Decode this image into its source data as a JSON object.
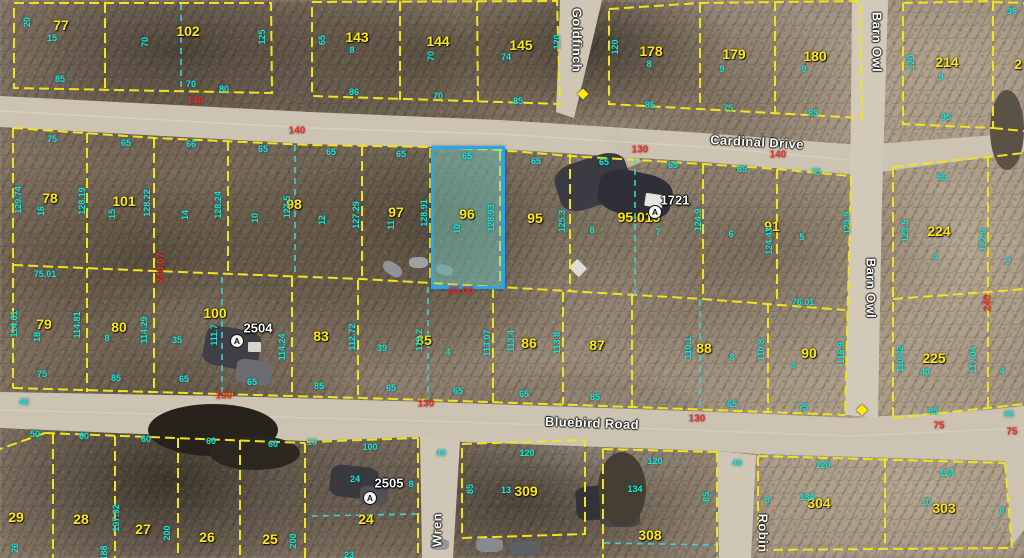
{
  "colors": {
    "parcel_line": "#f2e41c",
    "lot_split_dash": "#43cfd2",
    "highlight_stroke": "#2ba4e9",
    "highlight_fill": "rgba(118,212,201,0.45)",
    "lot_number": "#ffe912",
    "dimension_cyan": "#1de6da",
    "dimension_red": "#e03128",
    "road_fill": "#ccc3b2"
  },
  "highlight": {
    "parcel": "96",
    "x": 431,
    "y": 146,
    "w": 68,
    "h": 137
  },
  "roads": {
    "names": [
      [
        "Cardinal Drive",
        757,
        142,
        3
      ],
      [
        "Bluebird Road",
        592,
        423,
        2
      ],
      [
        "Barn Owl",
        877,
        42,
        90
      ],
      [
        "Barn Owl",
        871,
        288,
        90
      ],
      [
        "Goldfinch",
        577,
        40,
        90
      ],
      [
        "Wren",
        437,
        530,
        -90
      ],
      [
        "Robin",
        763,
        533,
        90
      ]
    ]
  },
  "labels": {
    "parcels": [
      [
        "77",
        61,
        25
      ],
      [
        "102",
        188,
        31
      ],
      [
        "143",
        357,
        37
      ],
      [
        "144",
        438,
        41
      ],
      [
        "145",
        521,
        45
      ],
      [
        "178",
        651,
        51
      ],
      [
        "179",
        734,
        54
      ],
      [
        "180",
        815,
        56
      ],
      [
        "214",
        947,
        62
      ],
      [
        "2",
        1018,
        64
      ],
      [
        "78",
        50,
        198
      ],
      [
        "101",
        124,
        201
      ],
      [
        "98",
        294,
        204
      ],
      [
        "97",
        396,
        212
      ],
      [
        "96",
        467,
        214
      ],
      [
        "95",
        535,
        218
      ],
      [
        "95.019",
        639,
        217
      ],
      [
        "91",
        772,
        226
      ],
      [
        "224",
        939,
        231
      ],
      [
        "79",
        44,
        324
      ],
      [
        "80",
        119,
        327
      ],
      [
        "100",
        215,
        313
      ],
      [
        "83",
        321,
        336
      ],
      [
        "85",
        424,
        340
      ],
      [
        "86",
        529,
        343
      ],
      [
        "87",
        597,
        345
      ],
      [
        "88",
        704,
        348
      ],
      [
        "90",
        809,
        353
      ],
      [
        "225",
        934,
        358
      ],
      [
        "29",
        16,
        517
      ],
      [
        "28",
        81,
        519
      ],
      [
        "27",
        143,
        529
      ],
      [
        "26",
        207,
        537
      ],
      [
        "25",
        270,
        539
      ],
      [
        "24",
        366,
        519
      ],
      [
        "309",
        526,
        491
      ],
      [
        "308",
        650,
        535
      ],
      [
        "304",
        819,
        503
      ],
      [
        "303",
        944,
        508
      ]
    ],
    "addresses": [
      [
        "1721",
        675,
        200
      ],
      [
        "2504",
        258,
        328
      ],
      [
        "2505",
        389,
        483
      ]
    ],
    "dims_cyan": [
      [
        "20",
        27,
        22,
        "v"
      ],
      [
        "15",
        52,
        38,
        "h"
      ],
      [
        "85",
        60,
        79,
        "h"
      ],
      [
        "70",
        145,
        42,
        "v"
      ],
      [
        "70",
        191,
        84,
        "h"
      ],
      [
        "80",
        224,
        89,
        "h"
      ],
      [
        "125",
        262,
        37,
        "v"
      ],
      [
        "65",
        322,
        40,
        "v"
      ],
      [
        "8",
        352,
        50,
        "h"
      ],
      [
        "86",
        354,
        92,
        "h"
      ],
      [
        "70",
        431,
        56,
        "v"
      ],
      [
        "70",
        438,
        96,
        "h"
      ],
      [
        "74",
        506,
        57,
        "h"
      ],
      [
        "85",
        518,
        101,
        "h"
      ],
      [
        "120",
        557,
        42,
        "v"
      ],
      [
        "120",
        615,
        47,
        "v"
      ],
      [
        "8",
        649,
        64,
        "h"
      ],
      [
        "85",
        650,
        105,
        "h"
      ],
      [
        "9",
        722,
        69,
        "h"
      ],
      [
        "75",
        728,
        108,
        "h"
      ],
      [
        "9",
        804,
        69,
        "h"
      ],
      [
        "85",
        813,
        113,
        "h"
      ],
      [
        "120",
        911,
        62,
        "v"
      ],
      [
        "9",
        941,
        77,
        "h"
      ],
      [
        "95",
        946,
        117,
        "h"
      ],
      [
        "36",
        1012,
        11,
        "h"
      ],
      [
        "75",
        52,
        139,
        "h"
      ],
      [
        "65",
        126,
        143,
        "h"
      ],
      [
        "66",
        191,
        144,
        "h"
      ],
      [
        "65",
        263,
        149,
        "h"
      ],
      [
        "65",
        331,
        152,
        "h"
      ],
      [
        "65",
        401,
        154,
        "h"
      ],
      [
        "65",
        467,
        156,
        "h"
      ],
      [
        "65",
        536,
        161,
        "h"
      ],
      [
        "65",
        604,
        162,
        "h"
      ],
      [
        "65",
        673,
        165,
        "h"
      ],
      [
        "65",
        742,
        169,
        "h"
      ],
      [
        "75",
        816,
        172,
        "h"
      ],
      [
        "95",
        942,
        177,
        "h"
      ],
      [
        "129.74",
        18,
        200,
        "v"
      ],
      [
        "16",
        41,
        211,
        "v"
      ],
      [
        "128.19",
        82,
        201,
        "v"
      ],
      [
        "15",
        112,
        214,
        "v"
      ],
      [
        "128.22",
        147,
        203,
        "v"
      ],
      [
        "14",
        185,
        215,
        "v"
      ],
      [
        "128.24",
        218,
        205,
        "v"
      ],
      [
        "10",
        255,
        218,
        "v"
      ],
      [
        "127.5",
        287,
        207,
        "v"
      ],
      [
        "12",
        322,
        220,
        "v"
      ],
      [
        "127.29",
        356,
        215,
        "v"
      ],
      [
        "11",
        391,
        225,
        "v"
      ],
      [
        "128.91",
        424,
        213,
        "v"
      ],
      [
        "10",
        457,
        229,
        "v"
      ],
      [
        "128.93",
        491,
        218,
        "v"
      ],
      [
        "125.3",
        562,
        221,
        "v"
      ],
      [
        "8",
        592,
        230,
        "h"
      ],
      [
        "7",
        658,
        232,
        "h"
      ],
      [
        "124.9",
        698,
        220,
        "v"
      ],
      [
        "6",
        731,
        234,
        "h"
      ],
      [
        "124.43",
        769,
        241,
        "v"
      ],
      [
        "5",
        802,
        237,
        "h"
      ],
      [
        "123.9",
        847,
        223,
        "v"
      ],
      [
        "123.5",
        905,
        231,
        "v"
      ],
      [
        "122.9",
        983,
        240,
        "v"
      ],
      [
        "4",
        935,
        257,
        "h"
      ],
      [
        "9",
        1008,
        261,
        "h"
      ],
      [
        "75.01",
        45,
        274,
        "h"
      ],
      [
        "76.01",
        803,
        302,
        "h"
      ],
      [
        "114.61",
        14,
        324,
        "v"
      ],
      [
        "18",
        37,
        337,
        "v"
      ],
      [
        "114.81",
        77,
        325,
        "v"
      ],
      [
        "8",
        107,
        338,
        "h"
      ],
      [
        "114.29",
        144,
        330,
        "v"
      ],
      [
        "35",
        177,
        340,
        "h"
      ],
      [
        "111.7",
        214,
        335,
        "v"
      ],
      [
        "114.24",
        282,
        347,
        "v"
      ],
      [
        "112.72",
        352,
        337,
        "v"
      ],
      [
        "39",
        382,
        348,
        "h"
      ],
      [
        "113.2",
        419,
        340,
        "v"
      ],
      [
        "4",
        448,
        352,
        "h"
      ],
      [
        "113.07",
        487,
        343,
        "v"
      ],
      [
        "113.4",
        511,
        341,
        "v"
      ],
      [
        "113.8",
        557,
        343,
        "v"
      ],
      [
        "110.1",
        688,
        348,
        "v"
      ],
      [
        "8",
        732,
        357,
        "h"
      ],
      [
        "110.8",
        761,
        350,
        "v"
      ],
      [
        "4",
        793,
        366,
        "h"
      ],
      [
        "116.9",
        841,
        353,
        "v"
      ],
      [
        "110.42",
        900,
        359,
        "v"
      ],
      [
        "40",
        925,
        372,
        "h"
      ],
      [
        "117.04",
        973,
        360,
        "v"
      ],
      [
        "4",
        1002,
        371,
        "h"
      ],
      [
        "75",
        42,
        374,
        "h"
      ],
      [
        "85",
        116,
        378,
        "h"
      ],
      [
        "65",
        184,
        379,
        "h"
      ],
      [
        "65",
        252,
        382,
        "h"
      ],
      [
        "85",
        319,
        386,
        "h"
      ],
      [
        "65",
        391,
        388,
        "h"
      ],
      [
        "65",
        458,
        391,
        "h"
      ],
      [
        "65",
        524,
        394,
        "h"
      ],
      [
        "85",
        595,
        397,
        "h"
      ],
      [
        "65",
        732,
        404,
        "h"
      ],
      [
        "75",
        803,
        407,
        "h"
      ],
      [
        "85",
        933,
        411,
        "h"
      ],
      [
        "65",
        1009,
        414,
        "h"
      ],
      [
        "40",
        24,
        402,
        "h"
      ],
      [
        "50",
        35,
        434,
        "h"
      ],
      [
        "60",
        84,
        436,
        "h"
      ],
      [
        "60",
        146,
        439,
        "h"
      ],
      [
        "60",
        211,
        441,
        "h"
      ],
      [
        "60",
        273,
        444,
        "h"
      ],
      [
        "10",
        312,
        442,
        "h"
      ],
      [
        "100",
        370,
        447,
        "h"
      ],
      [
        "24",
        355,
        479,
        "h"
      ],
      [
        "8",
        411,
        484,
        "h"
      ],
      [
        "40",
        441,
        453,
        "h"
      ],
      [
        "120",
        527,
        453,
        "h"
      ],
      [
        "85",
        470,
        489,
        "v"
      ],
      [
        "13",
        506,
        490,
        "h"
      ],
      [
        "120",
        655,
        461,
        "h"
      ],
      [
        "134",
        635,
        489,
        "h"
      ],
      [
        "85",
        706,
        497,
        "v"
      ],
      [
        "40",
        737,
        463,
        "h"
      ],
      [
        "120",
        823,
        465,
        "h"
      ],
      [
        "8",
        767,
        500,
        "h"
      ],
      [
        "134",
        807,
        497,
        "h"
      ],
      [
        "124",
        947,
        473,
        "h"
      ],
      [
        "10",
        926,
        502,
        "h"
      ],
      [
        "8",
        1002,
        511,
        "h"
      ],
      [
        "197.92",
        116,
        518,
        "v"
      ],
      [
        "200",
        167,
        533,
        "v"
      ],
      [
        "200",
        293,
        541,
        "v"
      ],
      [
        "26",
        15,
        548,
        "v"
      ],
      [
        "23",
        349,
        555,
        "h"
      ],
      [
        "188",
        104,
        553,
        "v"
      ]
    ],
    "dims_red": [
      [
        "140",
        195,
        101,
        "h"
      ],
      [
        "140",
        297,
        131,
        "h"
      ],
      [
        "130",
        640,
        150,
        "h"
      ],
      [
        "140",
        778,
        155,
        "h"
      ],
      [
        "240.07",
        161,
        268,
        "v"
      ],
      [
        "130",
        224,
        396,
        "h"
      ],
      [
        "130",
        426,
        404,
        "h"
      ],
      [
        "130",
        697,
        419,
        "h"
      ],
      [
        "75",
        939,
        426,
        "h"
      ],
      [
        "75",
        1012,
        432,
        "h"
      ],
      [
        "240",
        988,
        303,
        "v"
      ],
      [
        "65.00",
        461,
        291,
        "h"
      ]
    ],
    "markers_a": [
      [
        237,
        341
      ],
      [
        655,
        212
      ],
      [
        370,
        498
      ]
    ],
    "survey_dots": [
      [
        583,
        94
      ],
      [
        862,
        410
      ]
    ]
  },
  "geometry": {
    "yellow_lines": [
      "14,3 271,3 272,93 14,88 14,3",
      "105,3 105,90",
      "312,2 557,1 560,104 312,96 312,2",
      "400,1 400,100",
      "477,1 478,102",
      "609,9 700,3 860,1 862,118 609,104 609,9",
      "700,3 700,109",
      "775,1 775,113",
      "903,3 993,1 993,128 903,124 903,3",
      "993,2 1024,3",
      "993,128 1024,131",
      "13,128 155,138 310,145 430,147 500,150 570,156 703,164 777,169 851,176",
      "851,176 845,415",
      "13,128 13,388",
      "13,388 222,394 430,400 632,407 768,412 845,415",
      "13,265 155,271 362,279 500,287 703,299 845,310",
      "87,133 87,392",
      "154,138 154,393",
      "228,141 228,275",
      "362,146 362,279",
      "430,148 430,283",
      "500,151 500,287",
      "570,154 570,291",
      "703,164 703,299",
      "777,169 777,304",
      "292,277 292,396",
      "358,280 358,398",
      "493,288 493,402",
      "563,292 563,404",
      "632,295 632,407",
      "768,303 768,412",
      "893,167 988,157 1024,153",
      "893,167 893,418",
      "893,299 988,292 1024,289",
      "893,418 988,408 1024,404",
      "988,157 988,408",
      "45,433 305,443",
      "45,433 0,449",
      "53,434 53,558",
      "115,436 115,558",
      "178,438 178,558",
      "240,440 240,558",
      "305,443 305,558",
      "307,442 418,438",
      "418,438 418,558",
      "462,444 585,440 585,534 462,538 462,444",
      "603,449 717,452",
      "603,449 603,558",
      "717,452 717,558",
      "758,456 1005,463",
      "758,456 758,550",
      "885,458 885,549",
      "758,550 1012,548",
      "1005,463 1012,548"
    ],
    "cyan_dashed": [
      "181,4 181,92",
      "295,145 295,276",
      "222,277 222,395",
      "428,287 428,400",
      "635,158 635,298",
      "700,300 700,410",
      "312,516 417,514",
      "604,543 716,545"
    ]
  },
  "buildings": [
    [
      556,
      158,
      74,
      48,
      -18,
      "#3b3b43",
      30
    ],
    [
      598,
      172,
      74,
      44,
      12,
      "#2e2f37",
      35
    ],
    [
      645,
      194,
      18,
      13,
      8,
      "#e6e5e0",
      10
    ],
    [
      571,
      262,
      14,
      12,
      45,
      "#dedcd6",
      10
    ],
    [
      382,
      263,
      21,
      12,
      35,
      "#909396",
      40
    ],
    [
      409,
      257,
      19,
      11,
      0,
      "#9fa2a5",
      40
    ],
    [
      436,
      265,
      17,
      10,
      15,
      "#808386",
      40
    ],
    [
      204,
      328,
      56,
      40,
      10,
      "#403f45",
      25
    ],
    [
      236,
      360,
      36,
      24,
      8,
      "#6d6c70",
      25
    ],
    [
      248,
      342,
      13,
      10,
      0,
      "#d6d5d0",
      10
    ],
    [
      148,
      404,
      130,
      52,
      0,
      "#27221c",
      50
    ],
    [
      210,
      436,
      90,
      34,
      0,
      "#2d2721",
      50
    ],
    [
      330,
      466,
      48,
      32,
      6,
      "#3a393f",
      25
    ],
    [
      360,
      486,
      28,
      19,
      0,
      "#525158",
      25
    ],
    [
      576,
      485,
      64,
      34,
      -4,
      "#32333a",
      20
    ],
    [
      600,
      505,
      40,
      22,
      0,
      "#45464c",
      25
    ],
    [
      598,
      452,
      48,
      75,
      0,
      "#453e33",
      50
    ],
    [
      990,
      90,
      34,
      80,
      0,
      "#5a5245",
      50
    ],
    [
      476,
      538,
      27,
      14,
      0,
      "#888b8e",
      35
    ],
    [
      509,
      541,
      32,
      15,
      0,
      "#5d6065",
      35
    ],
    [
      430,
      539,
      19,
      11,
      0,
      "#94969a",
      35
    ]
  ]
}
